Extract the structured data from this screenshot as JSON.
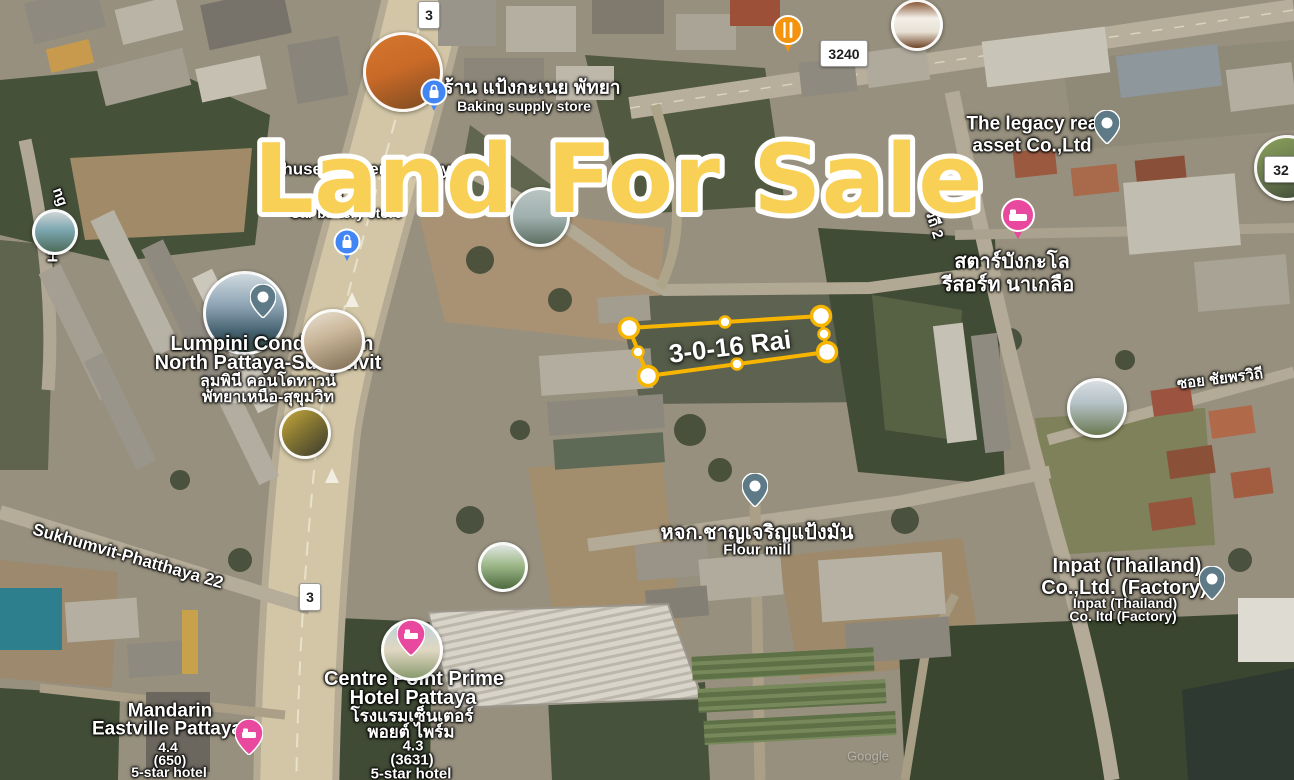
{
  "title": {
    "text": "Land For Sale",
    "color": "#F8D055"
  },
  "parcel": {
    "label": "3-0-16 Rai",
    "outline_color": "#F7B500"
  },
  "shields": {
    "a": "3",
    "b": "3240",
    "c": "3",
    "d": "32"
  },
  "roads": {
    "sukhumvit22": "Sukhumvit-Phatthaya 22",
    "soi_chaiyaphon": "ซอย ชัยพรวิถี",
    "soi_chaiyaphon2_fragment": "วิถี 2",
    "fragment_ng": "ng",
    "fragment_h": "H"
  },
  "places": {
    "baking": {
      "thai": "ร้าน แป้งกะเนย พัทยา",
      "en": "Baking supply store"
    },
    "chusee": {
      "en": "Chusee Battery Pattaya",
      "thai_fragment": "ชุ",
      "sub": "Car battery store"
    },
    "legacy": {
      "line1": "The legacy real",
      "line2": "asset Co.,Ltd"
    },
    "star_bungalow": {
      "line1": "สตาร์บังกะโล",
      "line2": "รีสอร์ท นาเกลือ"
    },
    "lumpini": {
      "en1": "Lumpini Condo Town",
      "en2": "North Pattaya-Sukumvit",
      "th1": "ลุมพินี คอนโดทาวน์",
      "th2": "พัทยาเหนือ-สุขุมวิท"
    },
    "flour_mill": {
      "thai": "หจก.ชาญเจริญแป้งมัน",
      "en": "Flour mill"
    },
    "inpat": {
      "line1": "Inpat (Thailand)",
      "line2": "Co.,Ltd. (Factory)",
      "sub1": "Inpat (Thailand)",
      "sub2": "Co. ltd (Factory)"
    },
    "centre_point": {
      "en1": "Centre Point Prime",
      "en2": "Hotel Pattaya",
      "th1": "โรงแรมเซ็นเตอร์",
      "th2": "พอยต์ ไพร์ม",
      "rating": "4.3",
      "reviews": "(3631)",
      "category": "5-star hotel"
    },
    "mandarin": {
      "en1": "Mandarin",
      "en2": "Eastville Pattaya",
      "rating": "4.4",
      "reviews": "(650)",
      "category": "5-star hotel"
    }
  },
  "icons": {
    "shopping_bag": {
      "name": "shopping-bag-icon",
      "color": "#4285F4"
    },
    "restaurant": {
      "name": "fork-knife-icon",
      "color": "#F4930D"
    },
    "hotel": {
      "name": "bed-icon",
      "color": "#E8499E"
    },
    "place_pin": {
      "name": "place-pin-icon",
      "color": "#5E7A87"
    }
  },
  "watermark": "Google"
}
